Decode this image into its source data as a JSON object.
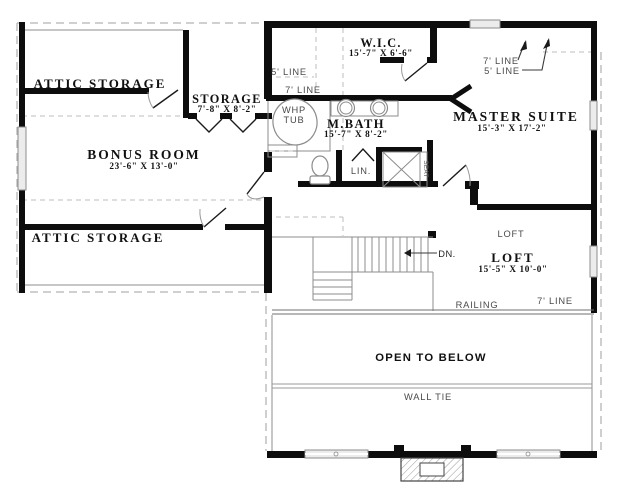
{
  "rooms": {
    "attic_storage_top": "ATTIC STORAGE",
    "attic_storage_bottom": "ATTIC STORAGE",
    "storage": "STORAGE",
    "storage_dims": "7'-8\" X 8'-2\"",
    "bonus_room": "BONUS ROOM",
    "bonus_room_dims": "23'-6\" X 13'-0\"",
    "wic": "W.I.C.",
    "wic_dims": "15'-7\" X 6'-6\"",
    "mbath": "M.BATH",
    "mbath_dims": "15'-7\" X 8'-2\"",
    "master_suite": "MASTER SUITE",
    "master_suite_dims": "15'-3\" X 17'-2\"",
    "loft": "LOFT",
    "loft_dims": "15'-5\" X 10'-0\"",
    "loft_area_tag": "LOFT",
    "open_to_below": "OPEN TO BELOW"
  },
  "annotations": {
    "five_line_wic": "5' LINE",
    "seven_line_bath": "7' LINE",
    "seven_line_master": "7' LINE",
    "five_line_master": "5' LINE",
    "seven_line_loft": "7' LINE",
    "railing": "RAILING",
    "wall_tie": "WALL TIE",
    "down": "DN.",
    "whp": "WHP",
    "tub": "TUB",
    "linen": "LIN.",
    "seat": "SEAT"
  },
  "colors": {
    "wall": "#0d0d0d",
    "thin_line": "#8c8c8c",
    "dashed_line": "#b5b5b5",
    "background": "#ffffff"
  }
}
